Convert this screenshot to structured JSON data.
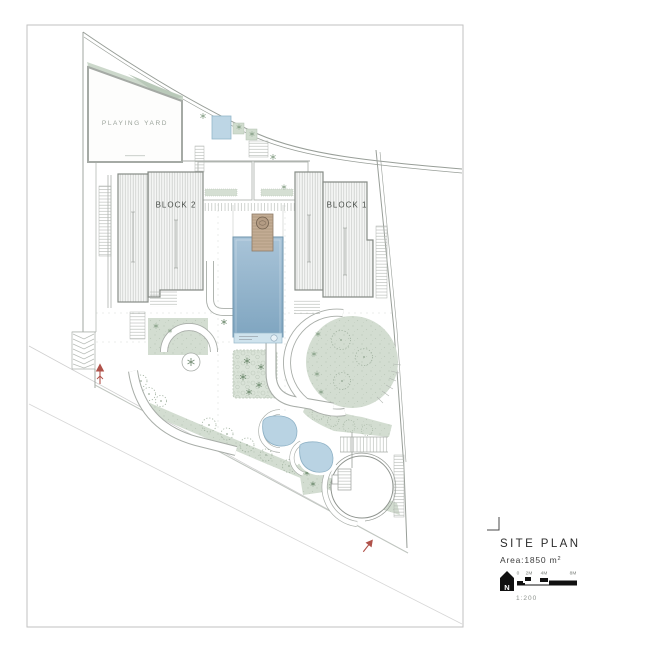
{
  "plan": {
    "playing_yard": "PLAYING YARD",
    "block_1": "BLOCK 1",
    "block_2": "BLOCK 2"
  },
  "title_block": {
    "title": "SITE PLAN",
    "area_text": "Area:1850 m",
    "area_sup": "2",
    "north_letter": "N",
    "scale_ticks": [
      "0",
      "2M",
      "4M",
      "8M"
    ],
    "scale_text": "1:200"
  },
  "colors": {
    "pool_blue": "#8fb2cb",
    "pond_blue": "#b9d3e3",
    "landscape_green": "#d3ddd1",
    "deck_tan": "#c3ac94",
    "building_hatch": "#c7cac7",
    "accent_red": "#b04a42",
    "ink": "#2b2b2b"
  }
}
